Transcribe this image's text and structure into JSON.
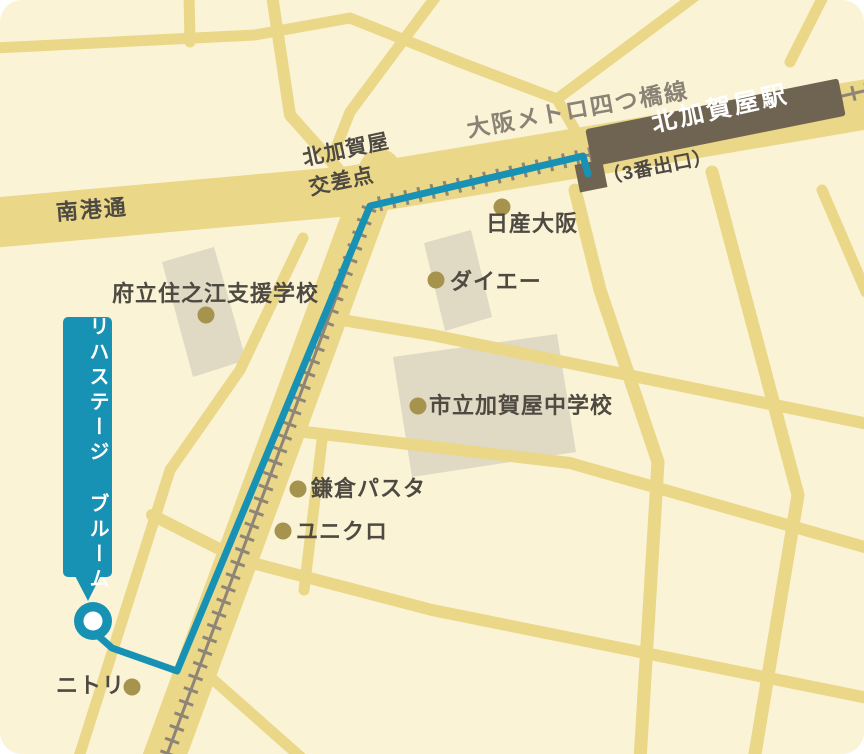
{
  "map": {
    "station": {
      "name": "北加賀屋駅",
      "exit_label": "（3番出口）"
    },
    "metro_line_label": "大阪メトロ四つ橋線",
    "road_label": "南港通",
    "intersection": {
      "line1": "北加賀屋",
      "line2": "交差点"
    },
    "destination": {
      "name": "リハステージ ブルーム"
    },
    "pois": [
      {
        "name": "日産大阪"
      },
      {
        "name": "ダイエー"
      },
      {
        "name": "府立住之江支援学校"
      },
      {
        "name": "市立加賀屋中学校"
      },
      {
        "name": "鎌倉パスタ"
      },
      {
        "name": "ユニクロ"
      },
      {
        "name": "ニトリ"
      }
    ],
    "colors": {
      "background": "#FAF3D6",
      "road": "#EAD788",
      "railway": "#8E8577",
      "station_block": "#6F6452",
      "building": "#E0D9C4",
      "route_accent": "#1792B4",
      "label_text": "#4E4A42",
      "metro_label_text": "#8A8275",
      "poi_dot": "#A5934E"
    }
  }
}
